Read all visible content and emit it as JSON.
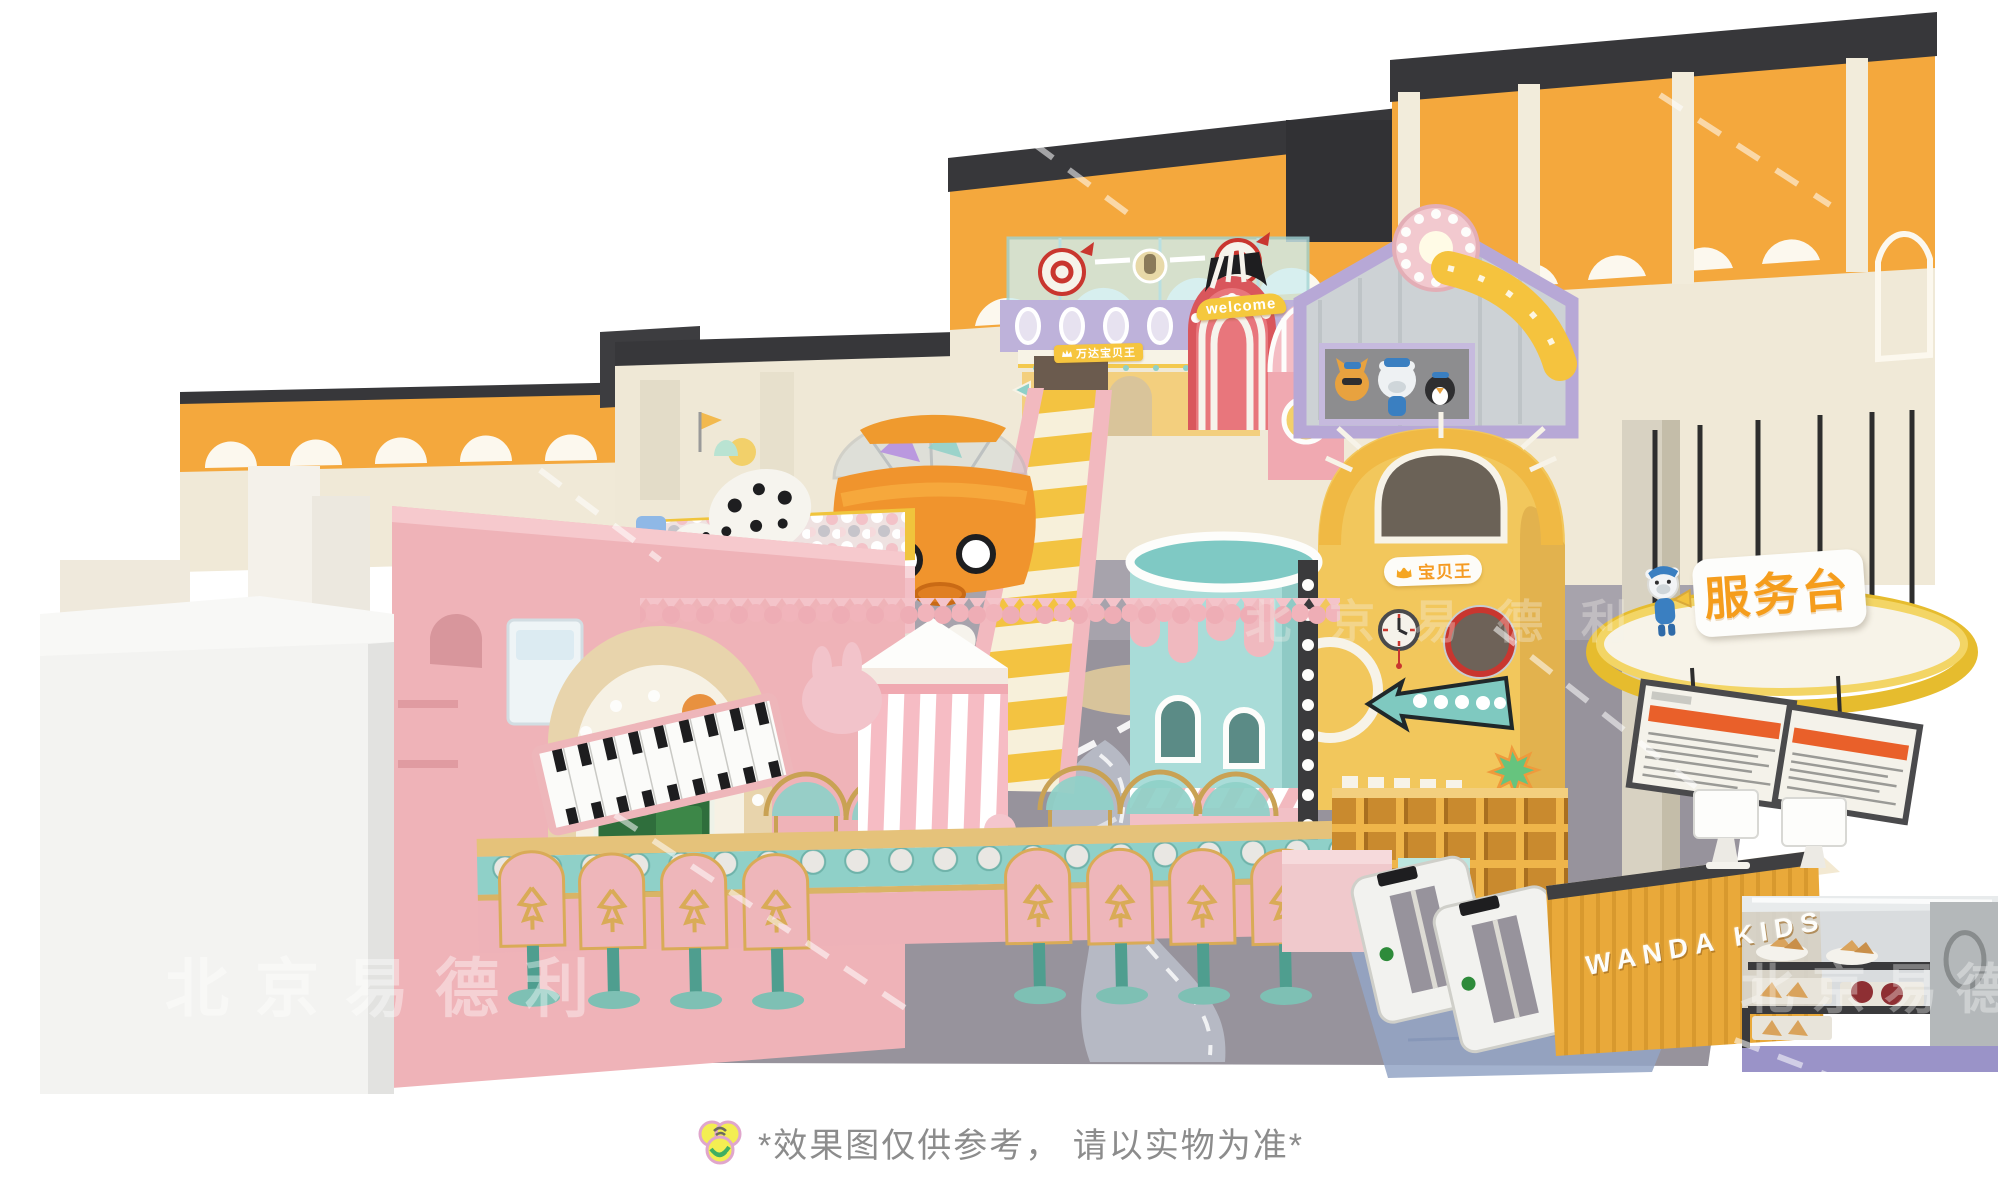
{
  "meta": {
    "description": "3D concept render of an indoor children's playground (Wanda Kids / 万达宝贝王) with pink walls, ball pit, slides, towers, service desk and reception counter on a white background"
  },
  "signs": {
    "service_desk_label": "服务台",
    "counter_brand": "WANDA KIDS",
    "brand_pill": "宝贝王",
    "kiosk_banner": "万达宝贝王",
    "welcome_banner": "welcome"
  },
  "watermark": {
    "text": "北京易德利"
  },
  "caption": {
    "text": "*效果图仅供参考， 请以实物为准*"
  },
  "colors": {
    "background": "#ffffff",
    "facade_orange": "#f4a83d",
    "facade_cream": "#f0e9d7",
    "coping_charcoal": "#37373a",
    "wall_pink": "#efb3b8",
    "block_white": "#f3f3f1",
    "slide_yellow": "#f3c341",
    "tower_teal": "#a9dcd8",
    "deck_purple": "#beb2da",
    "arch_red": "#d9565c",
    "floor_gray": "#97939c",
    "gold_trim": "#d9b465",
    "counter_yellow": "#e9a93a",
    "sign_orange": "#f59d1c",
    "menu_header_orange": "#e9602a",
    "starburst_green": "#66c47e",
    "mat_blue": "#93a4c6"
  }
}
